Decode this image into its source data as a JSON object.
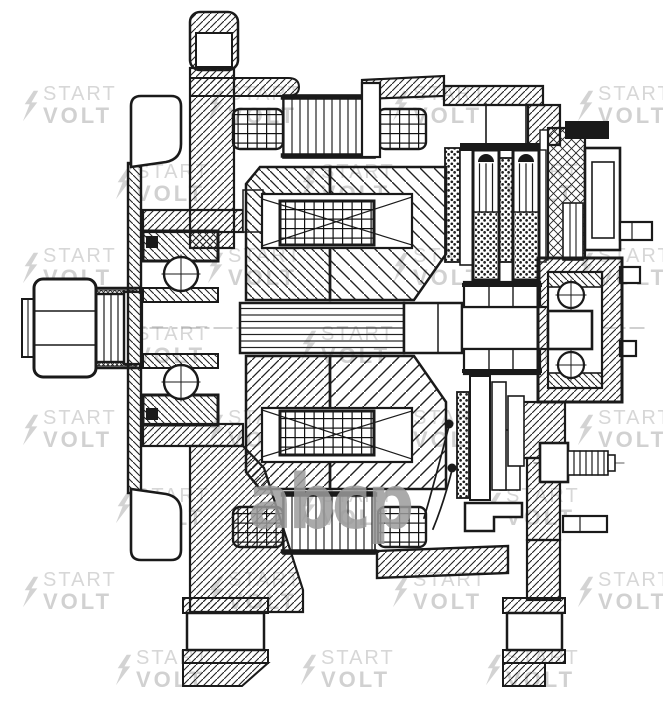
{
  "page": {
    "background": "#ffffff",
    "line_color": "#1a1a1a"
  },
  "watermark": {
    "line1": "START",
    "line2": "VOLT",
    "text_color": "#d7d7d7",
    "text2_color": "#d1d1d1",
    "bolt_color": "#d3d3d3",
    "center_logo_text": "abcp",
    "center_logo_color": "rgba(155,155,155,0.85)",
    "grid_a_origin": [
      22,
      84
    ],
    "grid_b_origin": [
      115,
      162
    ],
    "dx": 185,
    "dy": 162,
    "cols_a": 4,
    "rows_a": 4,
    "cols_b": 3,
    "rows_b": 4
  }
}
